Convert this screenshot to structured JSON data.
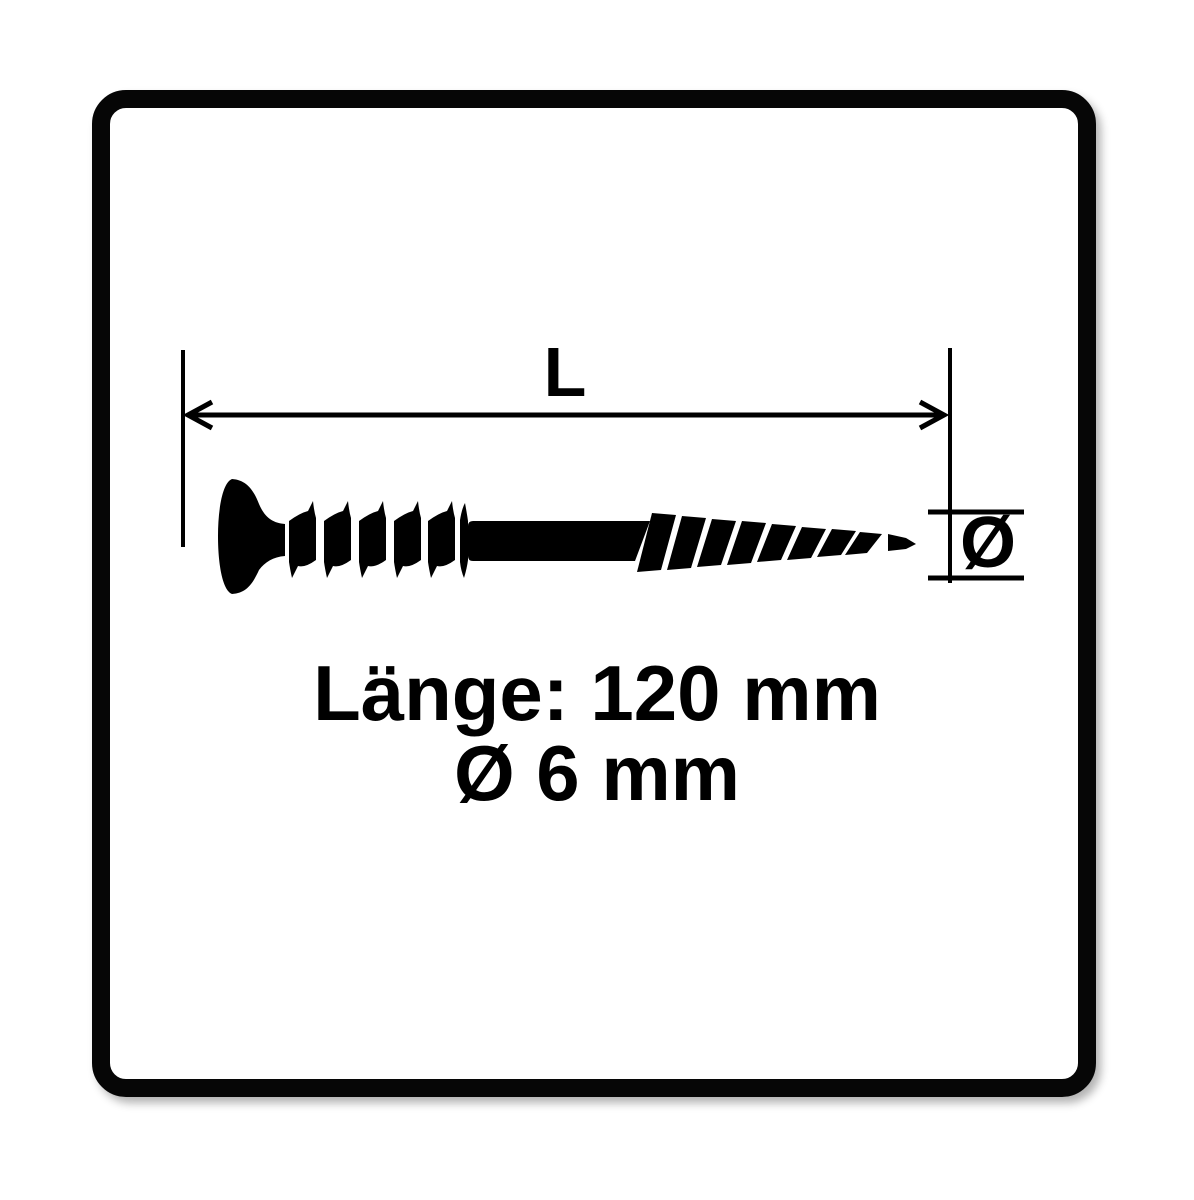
{
  "image": {
    "background_color": "#ffffff",
    "ink_color": "#000000",
    "frame": "rounded black border"
  },
  "dimension_annotations": {
    "length_label": "L",
    "diameter_symbol": "Ø"
  },
  "specs": {
    "length_text": "Länge: 120 mm",
    "diameter_text": "Ø 6 mm",
    "length_value": "120 mm",
    "diameter_value": "6 mm"
  }
}
